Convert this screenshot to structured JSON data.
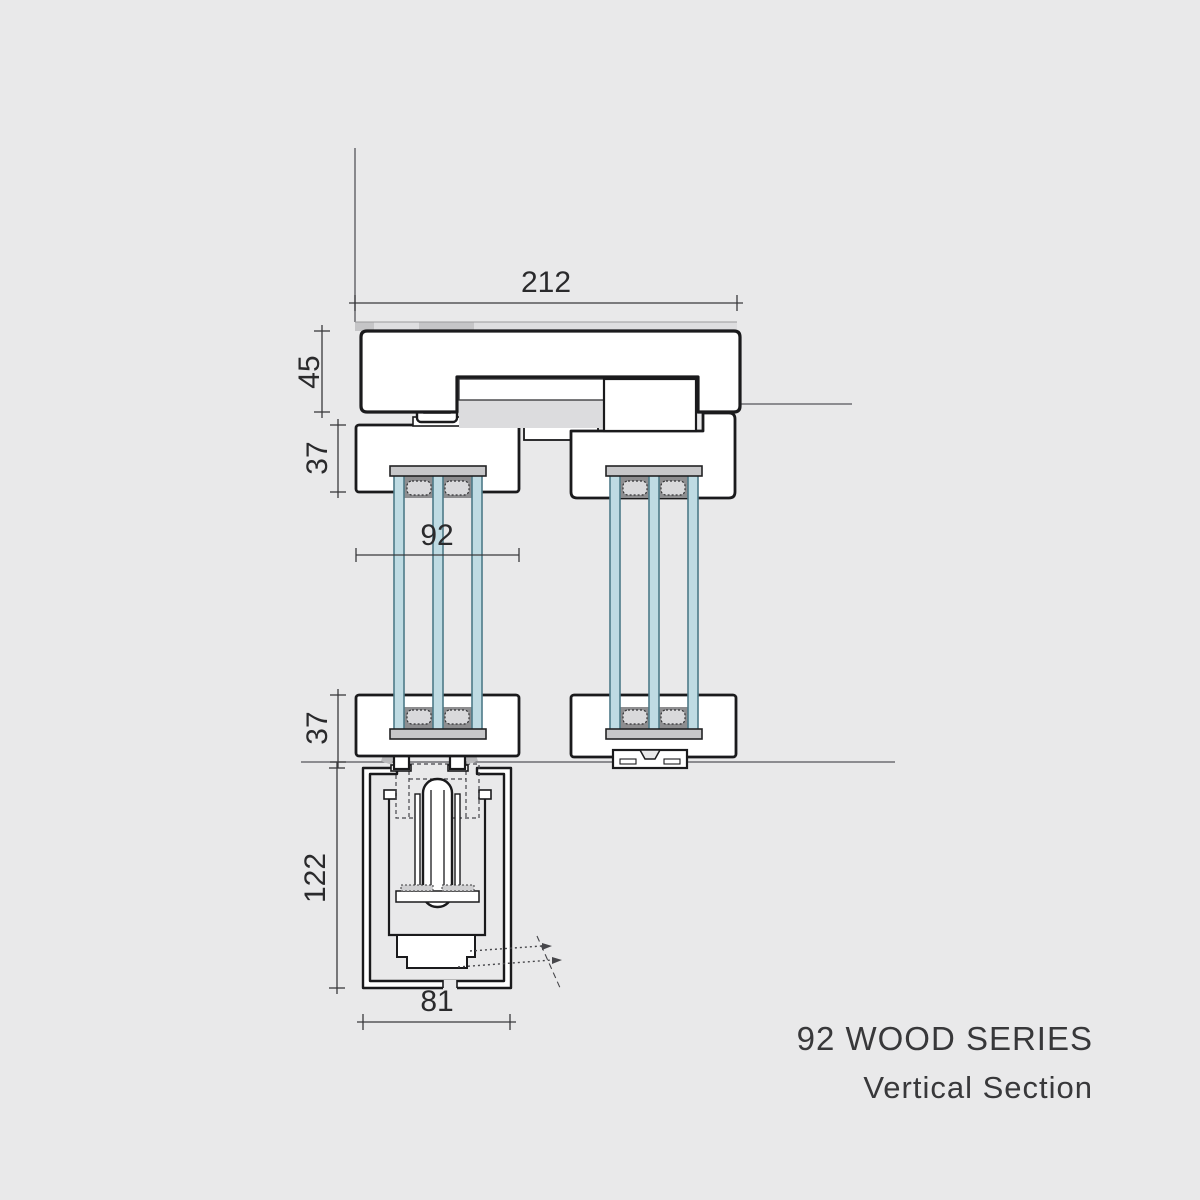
{
  "drawing": {
    "dimensions": {
      "overall_width": "212",
      "head_height": "45",
      "top_rail": "37",
      "sash_depth": "92",
      "bottom_rail": "37",
      "track_depth": "122",
      "track_width": "81"
    },
    "title": {
      "line1": "92 WOOD SERIES",
      "line2": "Vertical Section"
    },
    "colors": {
      "background": "#e9e9ea",
      "outline": "#1a1a1c",
      "profile_fill": "#ffffff",
      "glass_fill": "#bfdbe3",
      "glass_edge": "#4e7a88",
      "spacer_dark": "#8e8e90",
      "spacer_bar": "#d9d9db",
      "cap_gray": "#c7c7c9",
      "channel_gray": "#dcdcde",
      "dim_line": "#3a3a3c"
    }
  }
}
